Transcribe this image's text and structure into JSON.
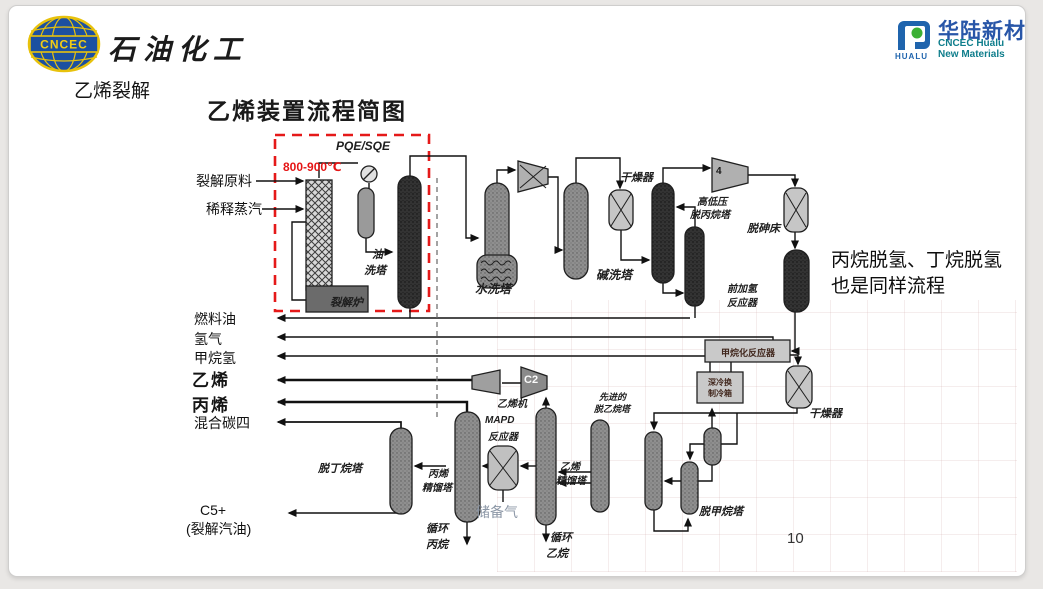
{
  "page": {
    "number": "10"
  },
  "header": {
    "logo_cncec": {
      "badge": "CNCEC",
      "name": "石油化工"
    },
    "section": "乙烯裂解",
    "title": "乙烯装置流程简图",
    "logo_hualu": {
      "badge": "HUALU",
      "name_cn": "华陆新材",
      "name_en_1": "CNCEC Hualu",
      "name_en_2": "New Materials"
    }
  },
  "note": {
    "line1": "丙烷脱氢、丁烷脱氢",
    "line2": "也是同样流程"
  },
  "annotations": {
    "temperature": "800-900℃",
    "quench_exchanger": "PQE/SQE"
  },
  "colors": {
    "accent_red": "#e51919",
    "hualu_blue": "#2856a8",
    "hualu_teal": "#0f7e8c",
    "cncec_blue": "#1c50a0",
    "cncec_yellow": "#e8c20c"
  },
  "streams": {
    "in1": "裂解原料",
    "in2": "稀释蒸汽",
    "fuel_oil": "燃料油",
    "hydrogen": "氢气",
    "methane_h2": "甲烷氢",
    "ethylene": "乙烯",
    "propylene": "丙烯",
    "mixed_c4": "混合碳四",
    "c5_line1": "C5+",
    "c5_line2": "(裂解汽油)",
    "recycle_propane_l1": "循环",
    "recycle_propane_l2": "丙烷",
    "recycle_ethane_l1": "循环",
    "recycle_ethane_l2": "乙烷",
    "reserve_gas": "储备气"
  },
  "equipment": {
    "furnace": "裂解炉",
    "oil_wash_l1": "油",
    "oil_wash_l2": "洗塔",
    "water_wash": "水洗塔",
    "caustic_wash": "碱洗塔",
    "dryer_1": "干燥器",
    "depropanizer_l1": "高低压",
    "depropanizer_l2": "脱丙烷塔",
    "compressor_4": "4",
    "arsine_bed": "脱砷床",
    "front_hydrogenation_l1": "前加氢",
    "front_hydrogenation_l2": "反应器",
    "methanation_reactor": "甲烷化反应器",
    "cold_box_l1": "深冷换",
    "cold_box_l2": "制冷箱",
    "dryer_2": "干燥器",
    "ethylene_compressor": "乙烯机",
    "compressor_c2": "C2",
    "mapd_l1": "MAPD",
    "mapd_l2": "反应器",
    "propylene_tower_l1": "丙烯",
    "propylene_tower_l2": "精馏塔",
    "debutanizer": "脱丁烷塔",
    "ethylene_tower_l1": "乙烯",
    "ethylene_tower_l2": "精馏塔",
    "deethanizer_l1": "先进的",
    "deethanizer_l2": "脱乙烷塔",
    "demethanizer": "脱甲烷塔"
  }
}
